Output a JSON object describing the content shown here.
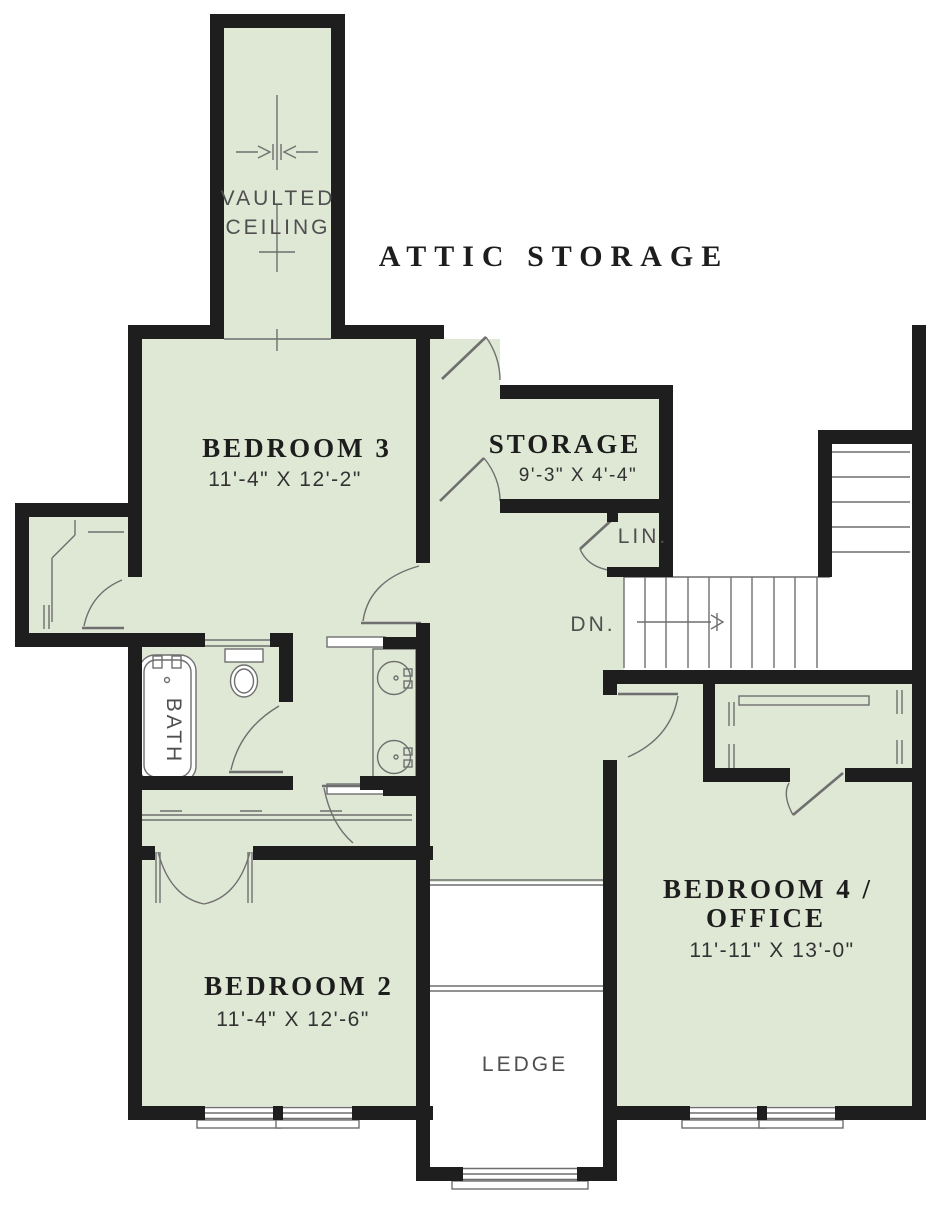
{
  "plan": {
    "title": "ATTIC STORAGE",
    "rooms": {
      "bedroom3": {
        "name": "BEDROOM 3",
        "dims": "11'-4\" X 12'-2\""
      },
      "storage": {
        "name": "STORAGE",
        "dims": "9'-3\" X 4'-4\""
      },
      "bedroom2": {
        "name": "BEDROOM 2",
        "dims": "11'-4\" X 12'-6\""
      },
      "bedroom4": {
        "name_line1": "BEDROOM 4 /",
        "name_line2": "OFFICE",
        "dims": "11'-11\" X 13'-0\""
      }
    },
    "labels": {
      "vaulted_line1": "VAULTED",
      "vaulted_line2": "CEILING",
      "linen": "LIN.",
      "down": "DN.",
      "bath": "BATH",
      "ledge": "LEDGE"
    },
    "colors": {
      "room_fill": "#dfe7d5",
      "wall": "#1e1e1e",
      "line": "#6f6f6f",
      "label": "#1d1d1d",
      "dim_label": "#333333",
      "thin_label": "#4f4f4f",
      "paper": "#ffffff"
    }
  }
}
